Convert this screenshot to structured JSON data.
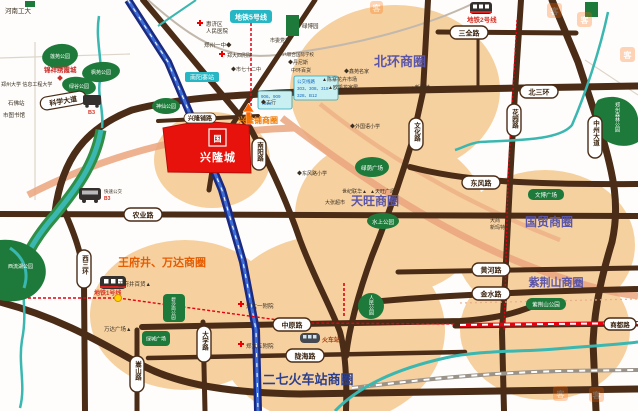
{
  "project": {
    "name": "兴隆城",
    "logo_glyph": "国"
  },
  "circles": {
    "beihuan": "北环商圈",
    "xinglongpu": "兴隆铺商圈",
    "tianwang": "天旺商圈",
    "guomao": "国贸商圈",
    "zijinshan": "紫荆山商圈",
    "wangfujing": "王府井、万达商圈",
    "erqi": "二七火车站商圈"
  },
  "roads": {
    "kexue": "科学大道",
    "sanquan": "三全路",
    "beisanhuan": "北三环",
    "huayuan": "花园路",
    "zhongzhou": "中州大道",
    "dongfeng": "东风路",
    "nongye": "农业路",
    "huanghe": "黄河路",
    "jinshui": "金水路",
    "zhongyuan": "中原路",
    "longhai": "陇海路",
    "shangdu": "商都路",
    "xisanhuan": "西三环",
    "songshan": "嵩山路",
    "daxue": "大学路",
    "nanyang": "南阳路",
    "wenhua": "文化路",
    "xinglongpu": "兴隆铺路"
  },
  "metro": {
    "line5": "地铁5号线",
    "line2": "地铁2号线",
    "line1": "地铁1号线",
    "nanyangzhai": "南阳寨站"
  },
  "parks": {
    "lianyuan": "莲苑公园",
    "fengyuan": "枫苑公园",
    "lvgu": "绿谷公园",
    "shenxian": "神仙公园",
    "lvbo": "绿博园",
    "lvyin": "绿荫广场",
    "shuishang": "水上公园",
    "renmin": "人民公园",
    "senlin": "郑州森林公园",
    "zijinshan": "紫荆山公园",
    "bishagang": "碧沙岗公园",
    "lvcheng": "绿城广场",
    "wenbo": "文博广场",
    "xiliuhu": "西流湖公园"
  },
  "pois": {
    "gongda": "河南工大",
    "xinxi": "郑州大学 信息工程大学",
    "shifo": "石佛站",
    "tushuguan": "市图书馆",
    "jinxiang": "锦祥绣霞城",
    "huiji1": "惠济区",
    "huiji2": "人民医院",
    "yizhong": "郑州一中◆",
    "sifuyuan": "郑大四附院",
    "qierzhong": "◆市七十二中",
    "dangxiao": "市委党校",
    "yiba": "一八联合国际学校",
    "dannisi": "◆丹尼斯",
    "zhonghuan": "中环百货",
    "gonghang": "◆工行",
    "waiguoyu": "◆外国语小学",
    "xinyuan": "◆鑫苑名家",
    "chenzhai": "▲陈寨花卉市场",
    "oukailong": "▲欧凯龙家居",
    "xinmate": "▲新玛特",
    "lianhua": "世纪联华▲",
    "tianwanggc": "▲天旺广场",
    "dazhang": "大张超市",
    "dongfengxx": "◆东风路小学",
    "dashang1": "大商",
    "dashang2": "新玛特",
    "wfjbh": "王府井百货▲",
    "wanda": "万达广场▲",
    "yifuyuan": "郑大一附院",
    "wufuyuan": "郑大五附院",
    "huochezhan": "火车站"
  },
  "transit": {
    "brt": "快速公交",
    "b3": "B3"
  },
  "callouts": {
    "c1": [
      "公交线路",
      "303、308、318",
      "328、B12"
    ],
    "c2": [
      "906、909",
      "Y816"
    ]
  },
  "watermark": {
    "glyph": "客"
  },
  "palette": {
    "road": "#4a2c17",
    "circle_fill": "#f5c98f",
    "park": "#1e7a3a",
    "river": "#3ab7b0",
    "parcel_red": "#e8120c",
    "metro_red": "#e60012",
    "expressway_blue": "#1b2a7e",
    "salmon": "#eba57e",
    "label_blue": "#5a55a8",
    "label_orange": "#ef7a00",
    "label_navy": "#2b3f8c"
  }
}
